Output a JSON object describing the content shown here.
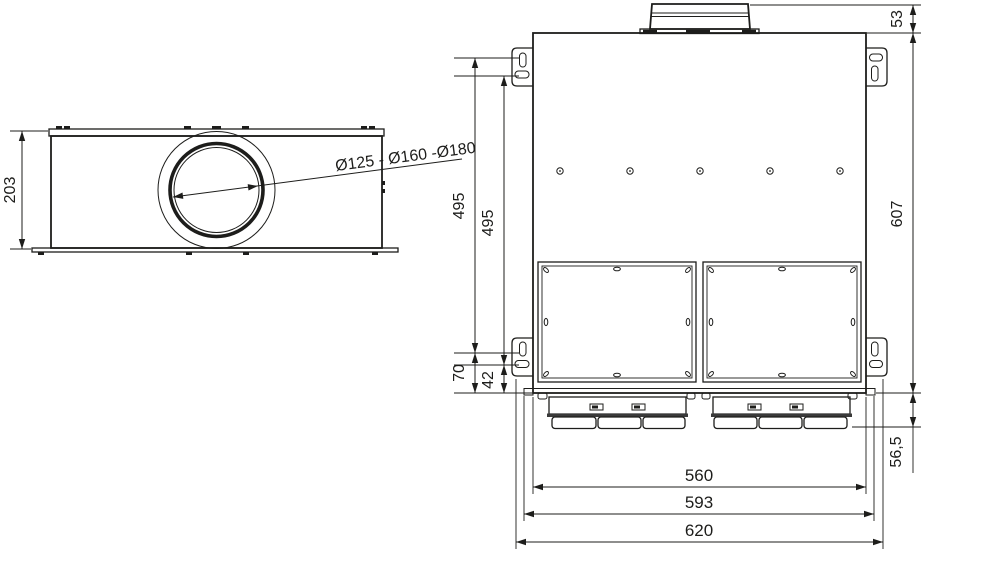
{
  "drawing": {
    "type": "dimensional technical drawing",
    "background": "#ffffff",
    "line_color": "#1d1d1b",
    "side_view": {
      "height_label": "203",
      "diameter_label": "Ø125 - Ø160 -Ø180"
    },
    "front_view": {
      "spigot_height_label": "53",
      "overall_height_label": "607",
      "slot_pitch_outer_label": "495",
      "slot_pitch_inner_label": "495",
      "slot_to_bottom_outer_label": "70",
      "slot_to_bottom_inner_label": "42",
      "connector_depth_label": "56,5",
      "body_width_label": "560",
      "flange_width_label": "593",
      "overall_width_label": "620"
    }
  }
}
